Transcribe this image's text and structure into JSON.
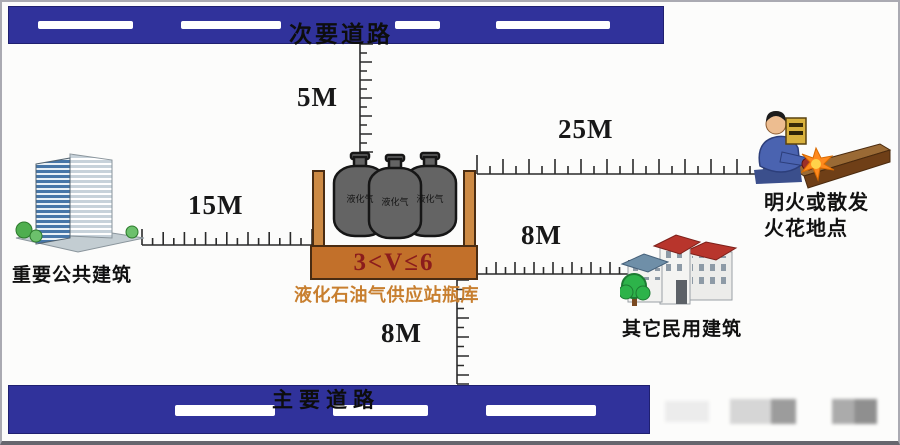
{
  "roads": {
    "secondary": "次要道路",
    "main": "主要道路"
  },
  "distances": {
    "station_to_secondary_road": "5M",
    "station_to_public_building": "15M",
    "station_to_flame_site": "25M",
    "station_to_civil_building": "8M",
    "station_to_main_road": "8M"
  },
  "station": {
    "volume_range": "3<V≤6",
    "name": "液化石油气供应站瓶库",
    "cylinder_label": "液化气"
  },
  "sites": {
    "public_building": "重要公共建筑",
    "civil_building": "其它民用建筑",
    "flame_site_line1": "明火或散发",
    "flame_site_line2": "火花地点"
  },
  "colors": {
    "road_blue": "#30329b",
    "lane_marking": "#ffffff",
    "container_wall": "#cd8a44",
    "container_base": "#c2702a",
    "volume_text_red": "#8b1c1c",
    "station_name_orange": "#c87f2f",
    "cylinder_gray": "#646464",
    "roof_red": "#b8352c",
    "roof_slate": "#6f8fa8",
    "tree_green": "#2db34a",
    "flame_orange": "#ff8a1e"
  }
}
